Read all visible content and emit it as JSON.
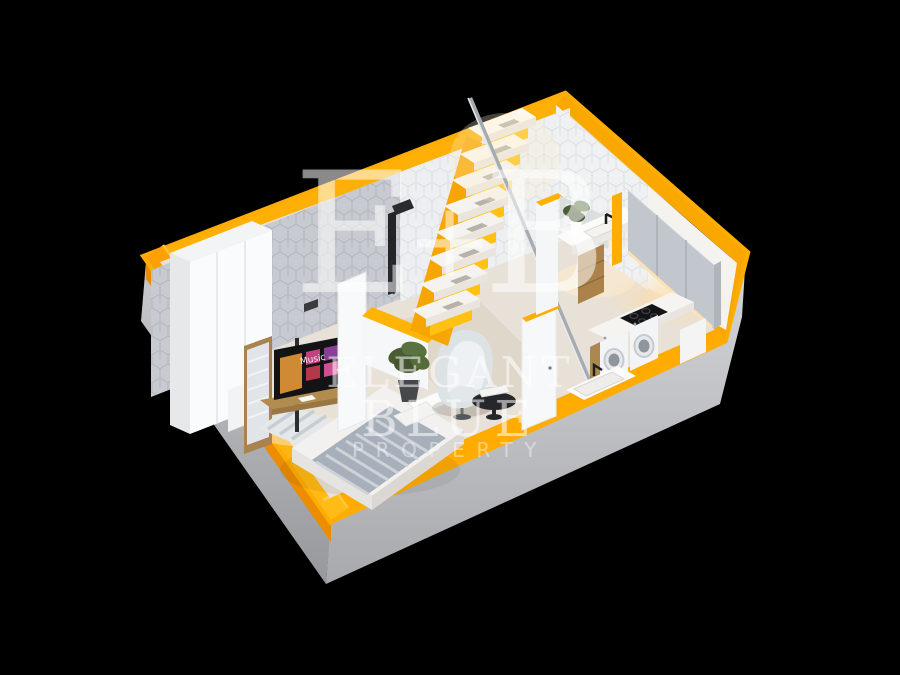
{
  "watermark": {
    "monogram_left": "E",
    "monogram_plus": "+",
    "monogram_right": "B",
    "brand_line1": "ELEGANT",
    "brand_line2": "BLUE",
    "brand_line3": "PROPERTY",
    "color": "#FFFFFF"
  },
  "tv": {
    "screen_label": "Music"
  },
  "palette": {
    "background": "#000000",
    "accent_yellow": "#FFAD05",
    "accent_orange": "#EC8C00",
    "slab_gray": "#C6C7CA",
    "floor_cream": "#E8E1D7",
    "wall_hex_gray": "#C7CAD0",
    "wall_hex_white": "#EDEFF0",
    "wood": "#AD8750",
    "warm_light": "#FFDCA4"
  },
  "scene": {
    "type": "3d-cutaway-floorplan",
    "rooms": [
      "bedroom",
      "shower-room",
      "staircase-nook",
      "bathroom",
      "kitchen"
    ],
    "furniture": [
      "wardrobe",
      "mirror",
      "tv-stand",
      "wall-shelf",
      "bed",
      "rug",
      "armchair",
      "side-table",
      "potted-plant",
      "staircase",
      "handrail",
      "shower-column",
      "bathroom-vanity",
      "bathroom-mirror",
      "bathroom-plant",
      "kitchen-upper-cabinets",
      "induction-cooktop",
      "washing-machine",
      "washing-machine",
      "kitchen-sink",
      "floor-slab"
    ]
  }
}
